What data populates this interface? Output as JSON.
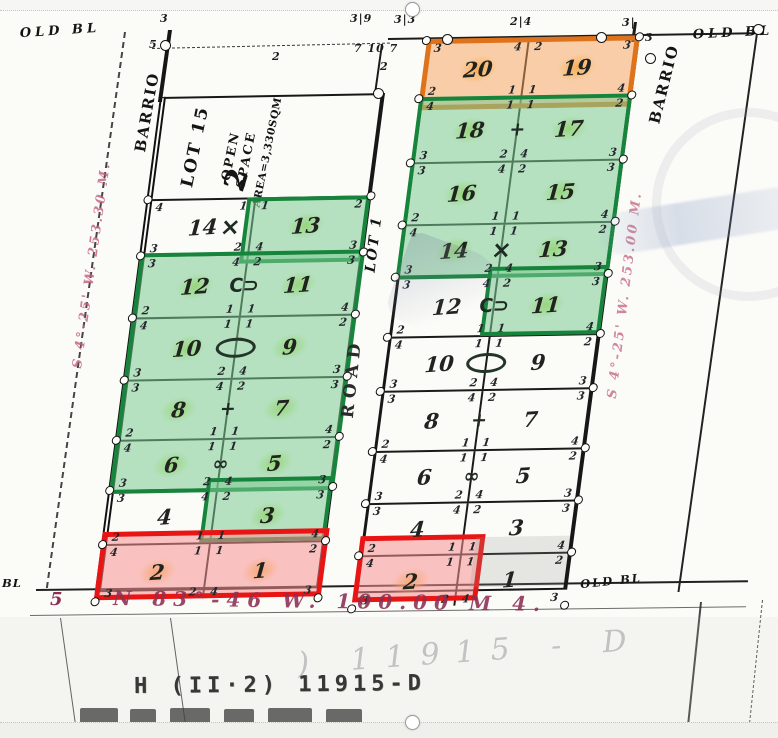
{
  "palette": {
    "green_fill": "#7ccc94",
    "green_border": "#17843c",
    "orange_fill": "#f5a058",
    "orange_border": "#df731b",
    "red_fill": "#f79494",
    "red_border": "#e91414",
    "highlighter_green": "#b8e05a",
    "highlighter_orange": "#f7be50",
    "ink": "#1c1c1c",
    "south_bearing_red": "#8c2f52",
    "meridian_pink": "#c2607e"
  },
  "labels": {
    "old_bl_top_left": "OLD BL",
    "old_bl_top_right": "OLD BL",
    "old_bl_bottom": "OLD BL",
    "bl_left_edge": "BL",
    "barrio_left": "BARRIO",
    "barrio_right": "BARRIO",
    "road": "ROAD",
    "road_lot": "LOT 1"
  },
  "open_space": {
    "lot": "LOT 15",
    "line1": "OPEN",
    "line2": "SPACE",
    "area": "AREA=3,330SQM",
    "block_number": "2"
  },
  "bearings": {
    "west_edge": "S 4°-25' W. 253.30 M.",
    "east_edge": "S 4°-25' W. 253.00 M.",
    "south_prefix": "5",
    "south": "N 83°-46 W. 100.00 M 4."
  },
  "bottom_title": {
    "typed": "H (II·2) 11915-D",
    "ghost": ") 11915 - D"
  },
  "left_block": {
    "rows": [
      {
        "nl": "14",
        "nr": "13",
        "hl": null,
        "hr": "g",
        "tt": [
          "4",
          "1",
          "1",
          "2"
        ],
        "tb": [
          "3",
          "2",
          "4",
          "3"
        ],
        "mark": "star"
      },
      {
        "nl": "12",
        "nr": "11",
        "hl": "g",
        "hr": "g",
        "tt": [
          "3",
          "4",
          "2",
          "3"
        ],
        "tb": [
          "2",
          "1",
          "1",
          "4"
        ],
        "mark": "hooks"
      },
      {
        "nl": "10",
        "nr": "9",
        "hl": "g",
        "hr": "g",
        "tt": [
          "4",
          "1",
          "1",
          "2"
        ],
        "tb": [
          "3",
          "2",
          "4",
          "3"
        ],
        "mark": "oval"
      },
      {
        "nl": "8",
        "nr": "7",
        "hl": "g",
        "hr": "g",
        "tt": [
          "3",
          "4",
          "2",
          "3"
        ],
        "tb": [
          "2",
          "1",
          "1",
          "4"
        ],
        "mark": "cross"
      },
      {
        "nl": "6",
        "nr": "5",
        "hl": "g",
        "hr": "g",
        "tt": [
          "4",
          "1",
          "1",
          "2"
        ],
        "tb": [
          "3",
          "2",
          "4",
          "3"
        ],
        "mark": "bowtie"
      },
      {
        "nl": "4",
        "nr": "3",
        "hl": null,
        "hr": "g",
        "tt": [
          "3",
          "4",
          "2",
          "3"
        ],
        "tb": [
          "2",
          "1",
          "1",
          "4"
        ],
        "mark": null
      },
      {
        "nl": "2",
        "nr": "1",
        "hl": "y",
        "hr": "y",
        "tt": [
          "4",
          "1",
          "1",
          "2"
        ],
        "tb": [
          "3",
          "2",
          "4",
          "3"
        ],
        "mark": null
      }
    ]
  },
  "right_block": {
    "rows": [
      {
        "nl": "20",
        "nr": "19",
        "hl": "y",
        "hr": "y",
        "tt": [
          "3",
          "4",
          "2",
          "3"
        ],
        "tb": [
          "2",
          "1",
          "1",
          "4"
        ],
        "mark": null
      },
      {
        "nl": "18",
        "nr": "17",
        "hl": "g",
        "hr": "g",
        "tt": [
          "4",
          "1",
          "1",
          "2"
        ],
        "tb": [
          "3",
          "2",
          "4",
          "3"
        ],
        "mark": "cross"
      },
      {
        "nl": "16",
        "nr": "15",
        "hl": "g",
        "hr": "g",
        "tt": [
          "3",
          "4",
          "2",
          "3"
        ],
        "tb": [
          "2",
          "1",
          "1",
          "4"
        ],
        "mark": null
      },
      {
        "nl": "14",
        "nr": "13",
        "hl": "g",
        "hr": "g",
        "tt": [
          "4",
          "1",
          "1",
          "2"
        ],
        "tb": [
          "3",
          "2",
          "4",
          "3"
        ],
        "mark": "star"
      },
      {
        "nl": "12",
        "nr": "11",
        "hl": null,
        "hr": "g",
        "tt": [
          "3",
          "4",
          "2",
          "3"
        ],
        "tb": [
          "2",
          "1",
          "1",
          "4"
        ],
        "mark": "hooks"
      },
      {
        "nl": "10",
        "nr": "9",
        "hl": null,
        "hr": null,
        "tt": [
          "4",
          "1",
          "1",
          "2"
        ],
        "tb": [
          "3",
          "2",
          "4",
          "3"
        ],
        "mark": "oval"
      },
      {
        "nl": "8",
        "nr": "7",
        "hl": null,
        "hr": null,
        "tt": [
          "3",
          "4",
          "2",
          "3"
        ],
        "tb": [
          "2",
          "1",
          "1",
          "4"
        ],
        "mark": "cross"
      },
      {
        "nl": "6",
        "nr": "5",
        "hl": null,
        "hr": null,
        "tt": [
          "4",
          "1",
          "1",
          "2"
        ],
        "tb": [
          "3",
          "2",
          "4",
          "3"
        ],
        "mark": "bowtie"
      },
      {
        "nl": "4",
        "nr": "3",
        "hl": null,
        "hr": null,
        "tt": [
          "3",
          "4",
          "2",
          "3"
        ],
        "tb": [
          "2",
          "1",
          "1",
          "4"
        ],
        "mark": null
      },
      {
        "nl": "2",
        "nr": "1",
        "hl": "y",
        "hr": null,
        "tt": [
          "4",
          "1",
          "1",
          "2"
        ],
        "tb": [
          "3",
          "2",
          "4",
          "3"
        ],
        "mark": null
      }
    ]
  },
  "top_ticks": [
    {
      "t": "3|9",
      "x": 350,
      "y": 12
    },
    {
      "t": "3|3",
      "x": 394,
      "y": 13
    },
    {
      "t": "2|4",
      "x": 510,
      "y": 15
    },
    {
      "t": "3|",
      "x": 622,
      "y": 16
    },
    {
      "t": "7 10 7",
      "x": 354,
      "y": 42
    },
    {
      "t": "3",
      "x": 645,
      "y": 31
    },
    {
      "t": "3",
      "x": 160,
      "y": 12
    },
    {
      "t": "5",
      "x": 149,
      "y": 38
    },
    {
      "t": "2",
      "x": 272,
      "y": 50
    },
    {
      "t": "2",
      "x": 380,
      "y": 60
    }
  ]
}
